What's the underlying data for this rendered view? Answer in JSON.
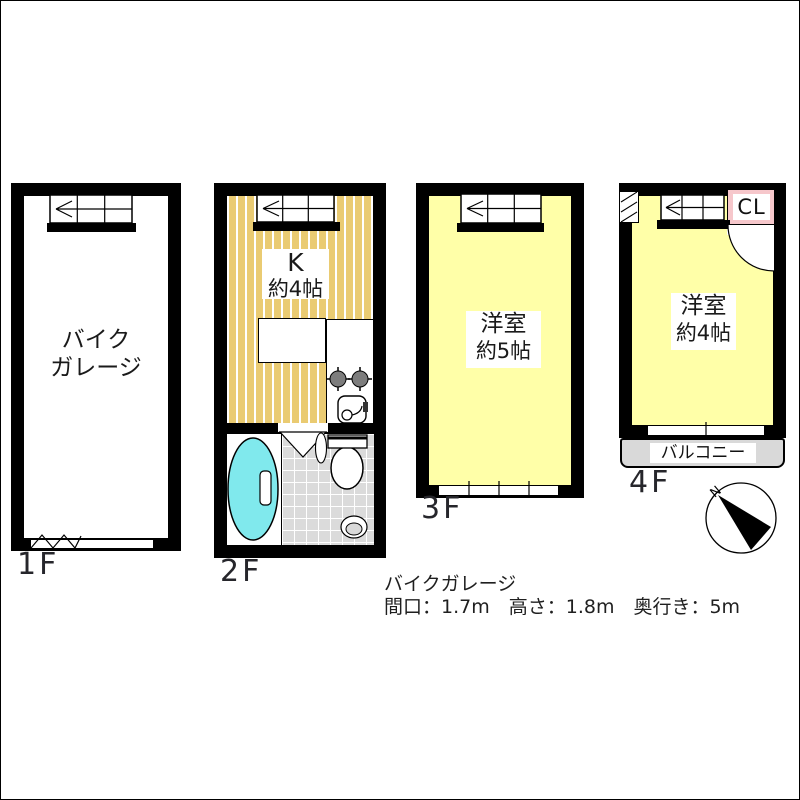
{
  "floors": [
    {
      "id": "1f",
      "floor_label": "1F",
      "room": {
        "line1": "バイク",
        "line2": "ガレージ"
      }
    },
    {
      "id": "2f",
      "floor_label": "2F",
      "kitchen": {
        "name": "K",
        "size": "約4帖"
      }
    },
    {
      "id": "3f",
      "floor_label": "3F",
      "room": {
        "name": "洋室",
        "size": "約5帖"
      }
    },
    {
      "id": "4f",
      "floor_label": "4F",
      "room": {
        "name": "洋室",
        "size": "約4帖"
      },
      "closet_label": "CL",
      "balcony_label": "バルコニー"
    }
  ],
  "notes": {
    "title": "バイクガレージ",
    "dimensions": "間口：1.7m　高さ：1.8m　奥行き：5m"
  },
  "compass": {
    "north_label": "N"
  },
  "colors": {
    "wall": "#000000",
    "garage_floor": "#FFFFFF",
    "kitchen_floor": "#EACB72",
    "room_floor": "#FFFFA8",
    "closet": "#F6C7CB",
    "balcony": "#D9D9D9",
    "bath_tile": "#DBDBDB",
    "bathtub": "#80E9ED"
  }
}
